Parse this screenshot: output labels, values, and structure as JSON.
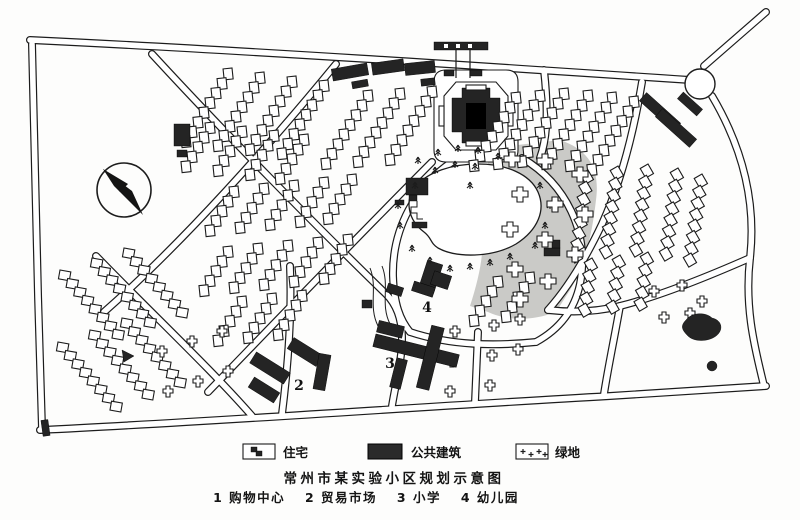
{
  "colors": {
    "ink": "#1c1c1c",
    "paper": "#fdfdfc",
    "green_area_fill": "#cacac7",
    "public_building_fill": "#242424"
  },
  "title": "常州市某实验小区规划示意图",
  "caption": {
    "items": [
      "1 购物中心",
      "2 贸易市场",
      "3 小学",
      "4 幼儿园"
    ]
  },
  "legend": {
    "items": [
      {
        "label": "住宅",
        "swatch": "residential-outline-box"
      },
      {
        "label": "公共建筑",
        "swatch": "solid-dark-box"
      },
      {
        "label": "绿地",
        "swatch": "cross-symbol-box"
      }
    ]
  },
  "map": {
    "compass": "north-arrow",
    "markers": [
      "2",
      "3",
      "4"
    ]
  }
}
